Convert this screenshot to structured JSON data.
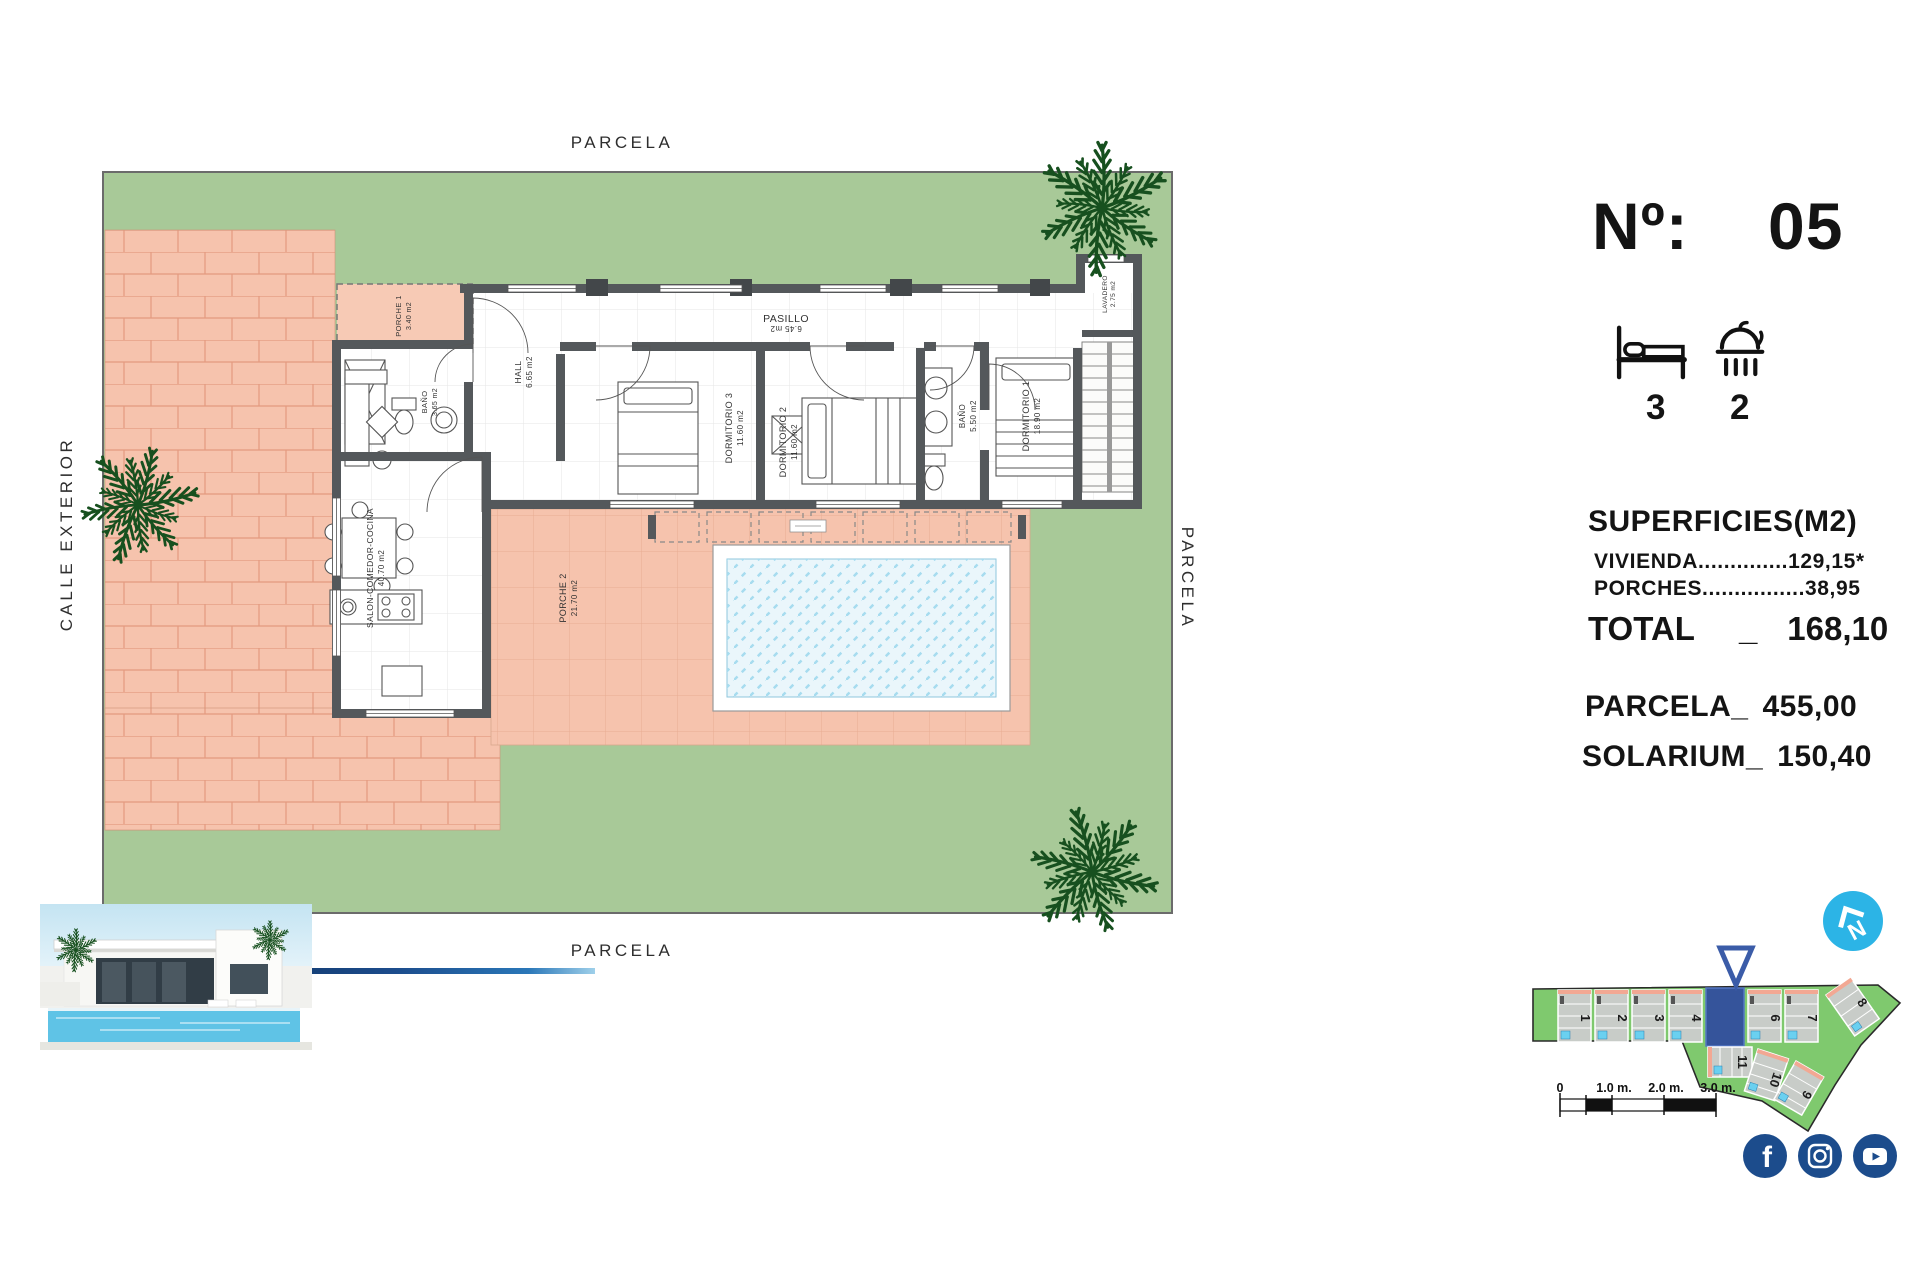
{
  "plot": {
    "label_top": "PARCELA",
    "label_bottom": "PARCELA",
    "label_right": "PARCELA",
    "label_left": "CALLE EXTERIOR"
  },
  "rooms": {
    "porche1": {
      "name": "PORCHE 1",
      "area": "3.40 m2"
    },
    "bano1": {
      "name": "BAÑO",
      "area": "3.65 m2"
    },
    "hall": {
      "name": "HALL",
      "area": "6.65 m2"
    },
    "salon": {
      "name": "SALON-COMEDOR-COCINA",
      "area": "40.70 m2"
    },
    "dormitorio3": {
      "name": "DORMITORIO 3",
      "area": "11.60 m2"
    },
    "pasillo": {
      "name": "PASILLO",
      "area": "6.45 m2"
    },
    "dormitorio2": {
      "name": "DORMITORIO 2",
      "area": "11.60 m2"
    },
    "bano2": {
      "name": "BAÑO",
      "area": "5.50 m2"
    },
    "dormitorio1": {
      "name": "DORMITORIO 1",
      "area": "18.90 m2"
    },
    "lavadero": {
      "name": "LAVADERO",
      "area": "2.75 m2"
    },
    "porche2": {
      "name": "PORCHE 2",
      "area": "21.70 m2"
    }
  },
  "panel": {
    "number_label": "Nº:",
    "number_value": "05",
    "beds_count": "3",
    "baths_count": "2",
    "surfaces_title": "SUPERFICIES(M2)",
    "vivienda_line": "VIVIENDA..............129,15*",
    "porches_line": "PORCHES................38,95",
    "total_label": "TOTAL",
    "total_sep": "_",
    "total_value": "168,10",
    "parcela_label": "PARCELA_",
    "parcela_value": "455,00",
    "solarium_label": "SOLARIUM_",
    "solarium_value": "150,40"
  },
  "sitemap": {
    "top_plots": [
      "1",
      "2",
      "3",
      "4",
      "6",
      "7",
      "8"
    ],
    "bottom_plots": [
      "11",
      "10",
      "9"
    ],
    "scale_labels": [
      "0",
      "1.0 m.",
      "2.0 m.",
      "3.0 m."
    ]
  },
  "icons": {
    "bed": "bed-icon",
    "shower": "shower-icon",
    "compass": "compass-north-icon",
    "facebook": "facebook-icon",
    "instagram": "instagram-icon",
    "youtube": "youtube-icon"
  },
  "colors": {
    "garden_green": "#a8c998",
    "paving_salmon": "#f6c3ad",
    "wall_gray": "#54585b",
    "pool_water": "#eaf6fb",
    "accent_blue": "#35549b",
    "compass_cyan": "#2cb4e6",
    "social_blue": "#1c4c8c",
    "sitemap_green": "#7fc96e"
  }
}
